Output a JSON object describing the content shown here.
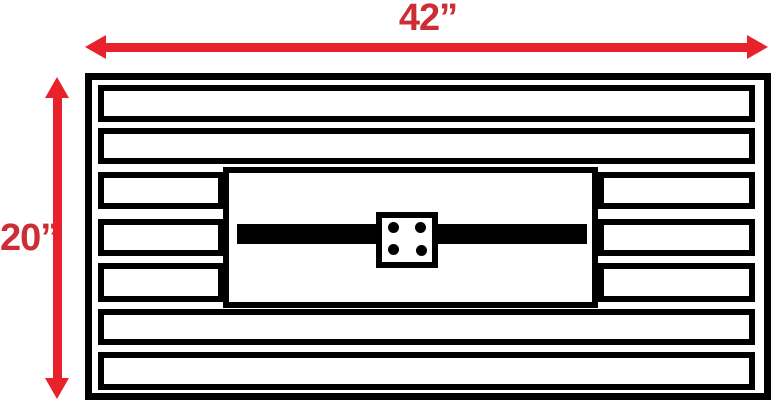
{
  "diagram": {
    "type": "dimensioned panel drawing",
    "width_label": "42”",
    "height_label": "20”",
    "panel": {
      "slat_count": 7,
      "split_slat_rows": [
        3,
        4,
        5
      ],
      "bolt_hole_count": 4
    }
  },
  "theme": {
    "arrow-red": "#e8222a",
    "label-red": "#cd2d34",
    "line-black": "#000000",
    "bg": "#ffffff"
  }
}
